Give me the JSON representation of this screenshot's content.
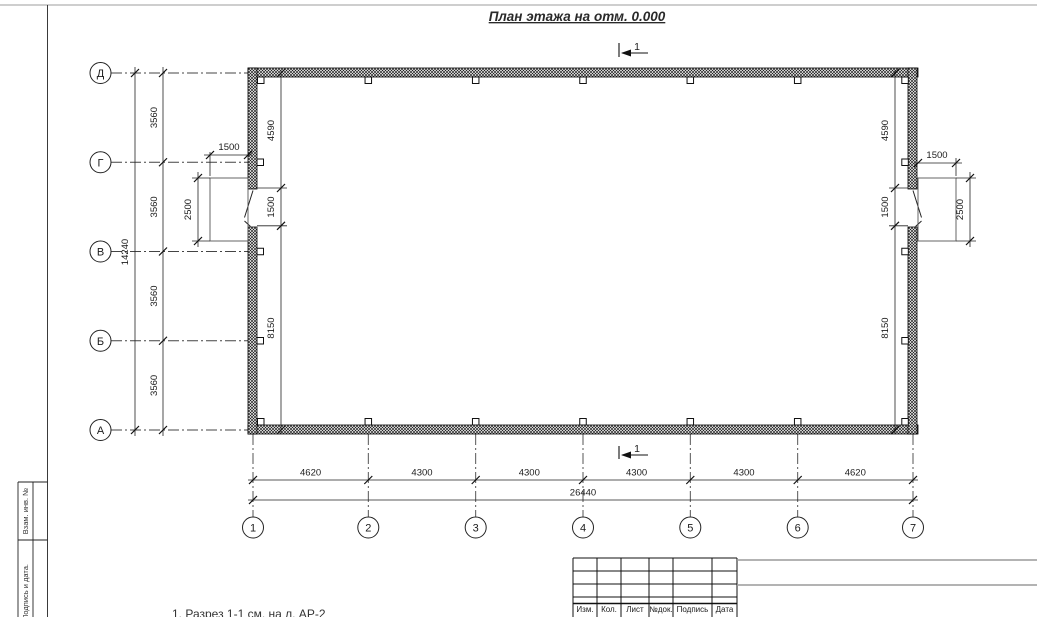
{
  "title": "План этажа на отм. 0.000",
  "section_marks": {
    "top": "1",
    "bottom": "1"
  },
  "axes": {
    "vertical": [
      "Д",
      "Г",
      "В",
      "Б",
      "А"
    ],
    "horizontal": [
      "1",
      "2",
      "3",
      "4",
      "5",
      "6",
      "7"
    ]
  },
  "dimensions": {
    "left_total": "14240",
    "left_segments": [
      "3560",
      "3560",
      "3560",
      "3560"
    ],
    "bottom_segments": [
      "4620",
      "4300",
      "4300",
      "4300",
      "4300",
      "4620"
    ],
    "bottom_total": "26440",
    "inner_left": [
      "4590",
      "1500",
      "8150"
    ],
    "inner_right": [
      "4590",
      "1500",
      "8150"
    ],
    "left_porch": {
      "width": "1500",
      "depth": "2500"
    },
    "right_porch": {
      "width": "1500",
      "depth": "2500"
    }
  },
  "note": "1. Разрез 1-1 см. на л. АР-2",
  "margin_labels": {
    "upper": "Взам. инв. №",
    "lower": "Подпись и дата."
  },
  "titleblock_columns": [
    "Изм.",
    "Кол.",
    "Лист",
    "№док.",
    "Подпись",
    "Дата"
  ]
}
